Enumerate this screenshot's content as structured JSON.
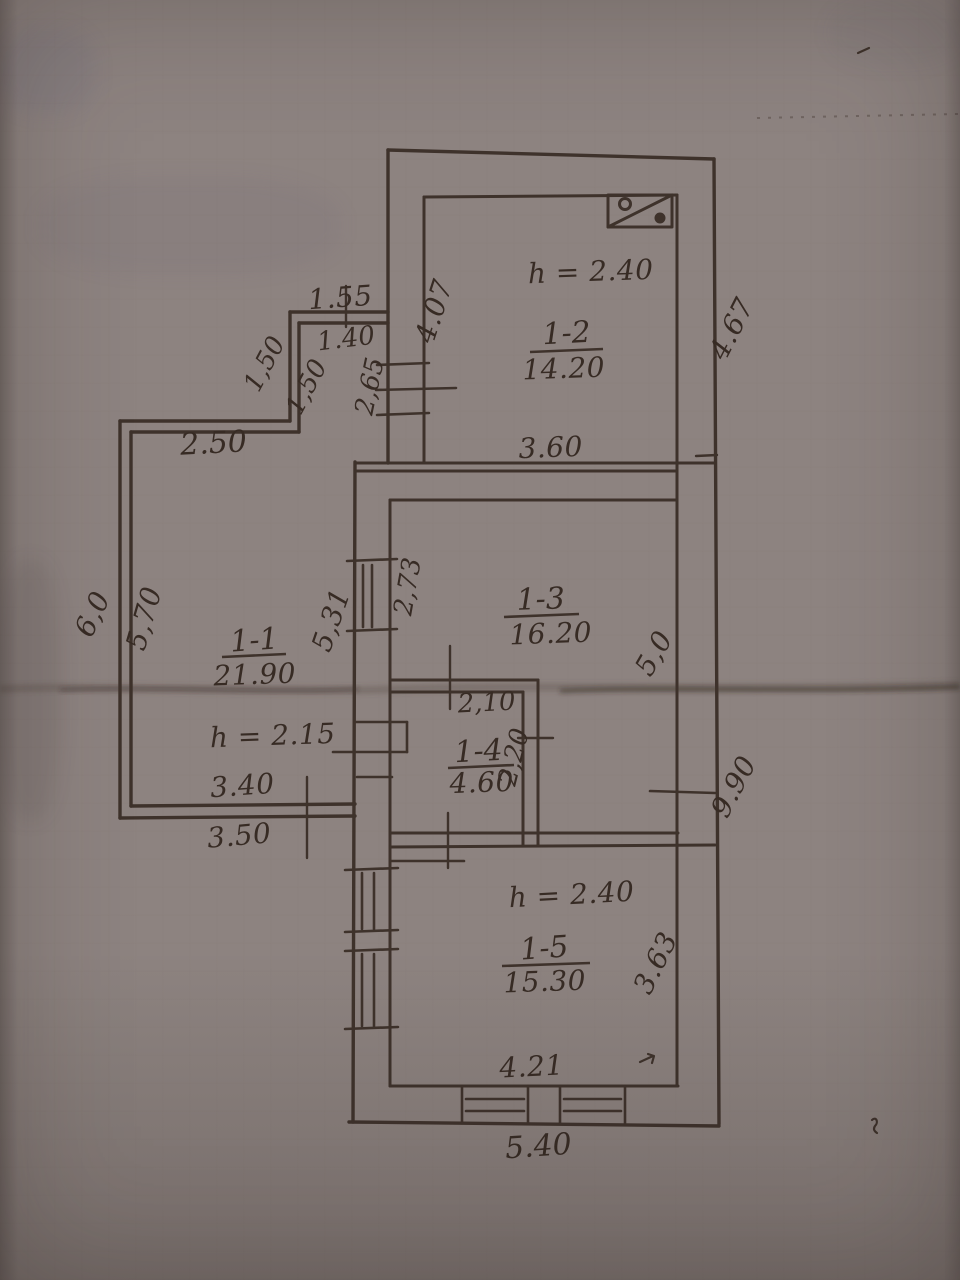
{
  "plan": {
    "rooms": [
      {
        "number": "1-2",
        "area": "14.20"
      },
      {
        "number": "1-3",
        "area": "16.20"
      },
      {
        "number": "1-4",
        "area": "4.60"
      },
      {
        "number": "1-5",
        "area": "15.30"
      },
      {
        "number": "1-1",
        "area": "21.90"
      }
    ],
    "heights": {
      "room_1_2": "h = 2.40",
      "room_1_1": "h = 2.15",
      "room_1_5": "h = 2.40"
    },
    "dimensions": {
      "porch_top": "1.55",
      "porch_top_inner": "1.40",
      "porch_side_outer": "1,50",
      "porch_side_inner": "1,50",
      "window_1_2_left": "2,65",
      "room_1_2_left": "4.07",
      "right_upper": "4.67",
      "left_top": "2.50",
      "room_1_2_bottom": "3.60",
      "left_outer": "6,0",
      "left_inner": "5,70",
      "room_1_1_right": "5,31",
      "window_1_3_left": "2,73",
      "room_1_3_right": "5,0",
      "room_1_4_top": "2,10",
      "room_1_4_right": "2,20",
      "right_lower": "9.90",
      "room_1_1_bottom_inner": "3.40",
      "room_1_1_bottom_outer": "3.50",
      "room_1_5_right": "3.63",
      "room_1_5_bottom": "4.21",
      "bottom_outer": "5.40"
    },
    "colors": {
      "ink": "#3e322b",
      "paper_light": "#c6bcb9",
      "paper_dark": "#7c7370"
    },
    "symbols": {
      "stove": "stove-flue-rect-with-diagonal-and-circles"
    }
  }
}
